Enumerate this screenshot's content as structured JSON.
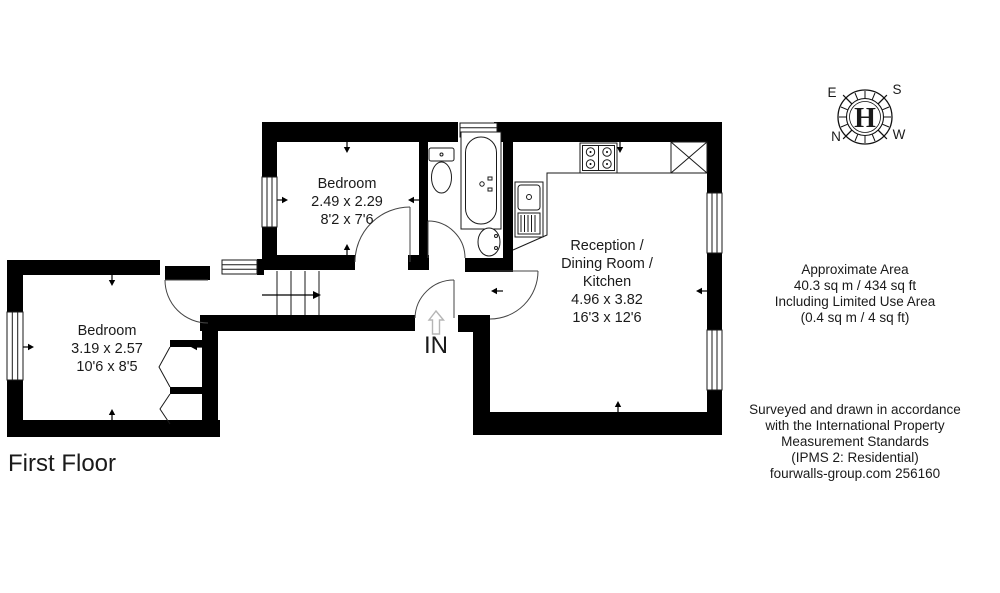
{
  "floor_plan": {
    "title": "First Floor",
    "entrance_label": "IN",
    "rooms": {
      "bedroom_top": {
        "name": "Bedroom",
        "size_metric": "2.49 x 2.29",
        "size_imperial": "8'2 x 7'6"
      },
      "bedroom_left": {
        "name": "Bedroom",
        "size_metric": "3.19 x 2.57",
        "size_imperial": "10'6 x 8'5"
      },
      "reception": {
        "name_lines": [
          "Reception /",
          "Dining Room /",
          "Kitchen"
        ],
        "size_metric": "4.96 x 3.82",
        "size_imperial": "16'3 x 12'6"
      }
    },
    "fixtures": [
      "bathtub",
      "toilet",
      "basin",
      "kitchen-sink",
      "hob",
      "stairs",
      "void-cross"
    ]
  },
  "compass": {
    "logo": "H",
    "cardinal": {
      "east": "E",
      "south": "S",
      "north": "N",
      "west": "W"
    }
  },
  "notes": {
    "area": {
      "lines": [
        "Approximate Area",
        "40.3 sq m / 434 sq ft",
        "Including Limited Use Area",
        "(0.4 sq m / 4 sq ft)"
      ]
    },
    "survey": {
      "lines": [
        "Surveyed and drawn in accordance",
        "with the International Property",
        "Measurement Standards",
        "(IPMS 2: Residential)",
        "fourwalls-group.com 256160"
      ]
    }
  },
  "colors": {
    "wall": "#000000",
    "text": "#1a1a1a",
    "entrance_arrow": "#b5b5b5",
    "background": "#ffffff"
  }
}
